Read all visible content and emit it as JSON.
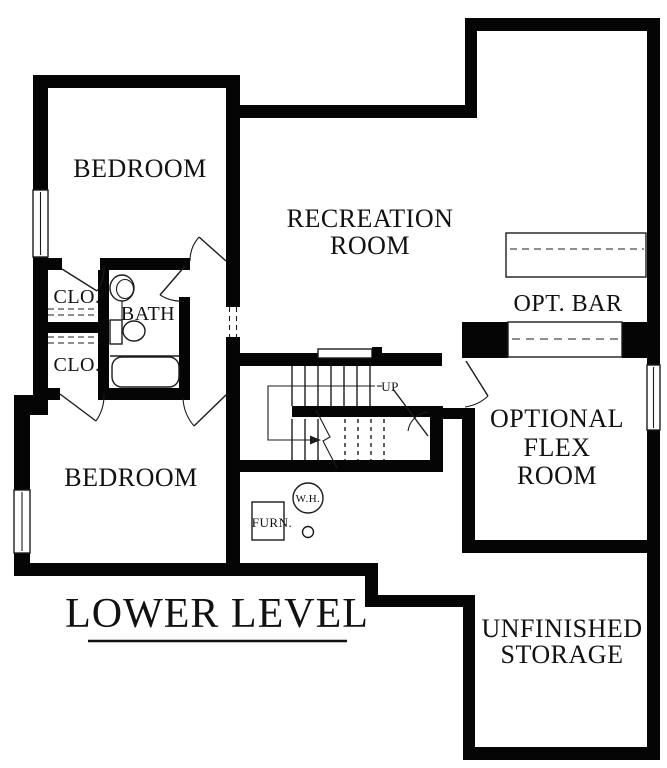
{
  "plan": {
    "title": "LOWER LEVEL",
    "labels": {
      "bedroom_upper": "BEDROOM",
      "closet_upper": "CLO.",
      "bath": "BATH",
      "closet_lower": "CLO.",
      "bedroom_lower": "BEDROOM",
      "recreation_1": "RECREATION",
      "recreation_2": "ROOM",
      "opt_bar": "OPT. BAR",
      "flex_1": "OPTIONAL",
      "flex_2": "FLEX",
      "flex_3": "ROOM",
      "storage_1": "UNFINISHED",
      "storage_2": "STORAGE",
      "up": "UP",
      "water_heater": "W.H.",
      "furnace": "FURN."
    },
    "colors": {
      "wall": "#050505",
      "line": "#1c1c1c",
      "background": "#ffffff"
    }
  }
}
